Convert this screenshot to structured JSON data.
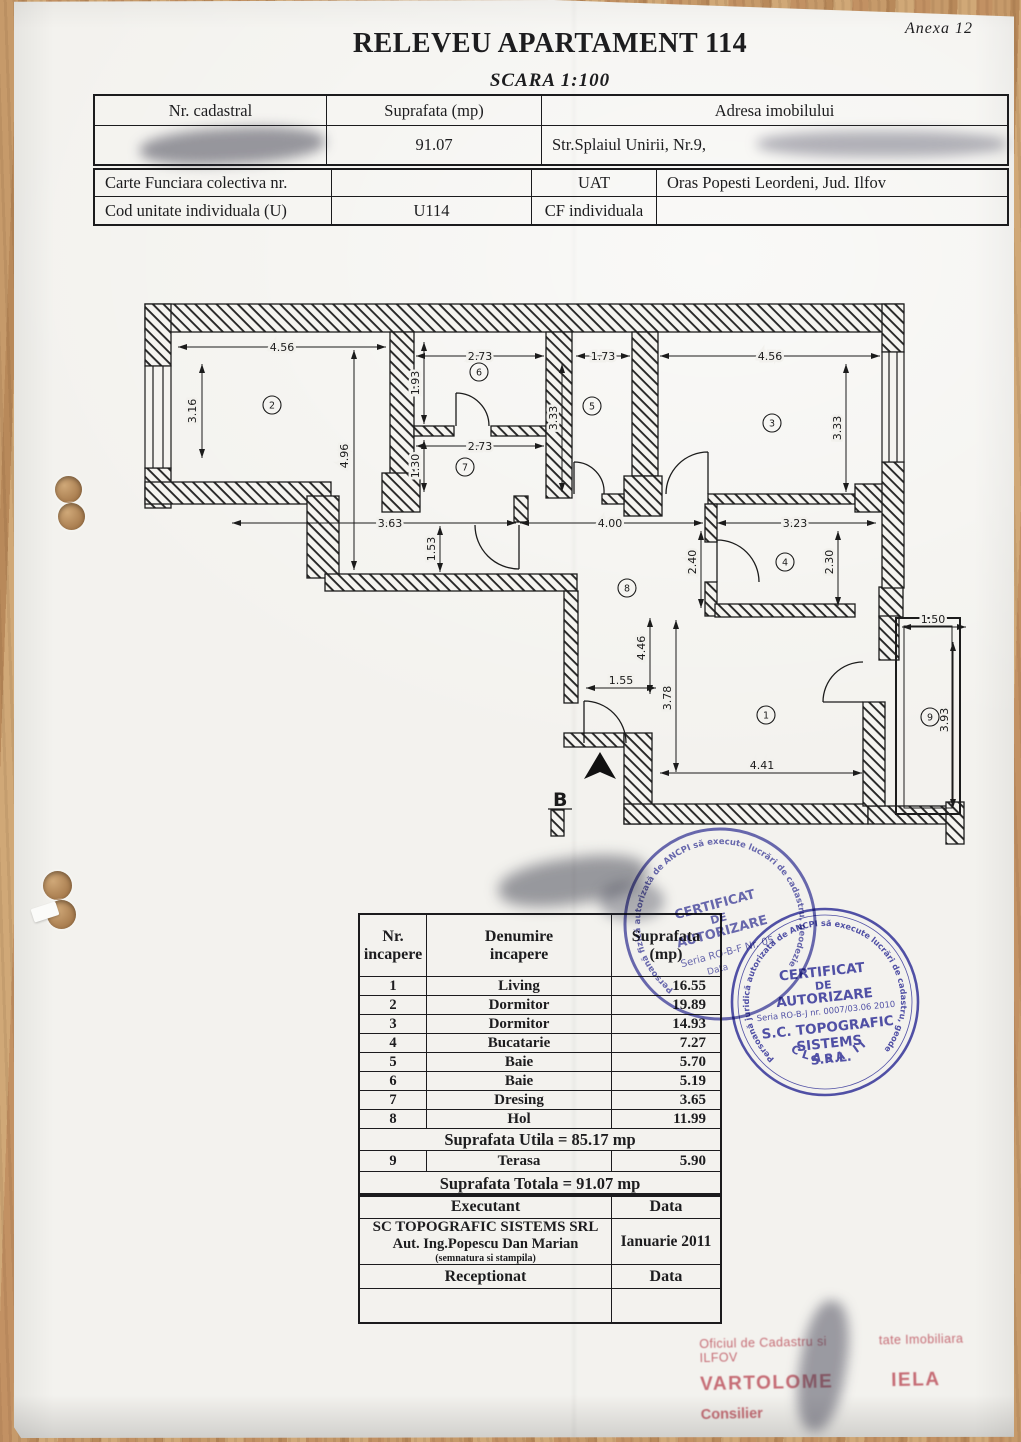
{
  "header": {
    "anexa": "Anexa 12",
    "title": "RELEVEU APARTAMENT 114",
    "scale": "SCARA 1:100"
  },
  "info_table": {
    "col1": "Nr. cadastral",
    "col2": "Suprafata (mp)",
    "col3": "Adresa imobilului",
    "area_value": "91.07",
    "address_value": "Str.Splaiul Unirii, Nr.9,"
  },
  "legal_table": {
    "row1_label": "Carte Funciara colectiva nr.",
    "uat_label": "UAT",
    "uat_value": "Oras Popesti Leordeni, Jud. Ilfov",
    "row2_label": "Cod unitate individuala (U)",
    "unit_value": "U114",
    "cf_label": "CF individuala"
  },
  "plan": {
    "north_label": "B",
    "room_numbers": {
      "r1": "1",
      "r2": "2",
      "r3": "3",
      "r4": "4",
      "r5": "5",
      "r6": "6",
      "r7": "7",
      "r8": "8",
      "r9": "9"
    },
    "dims": {
      "room2_w": "4.56",
      "room2_h": "3.16",
      "left_h": "4.96",
      "room6_w": "2.73",
      "room6_h": "1.93",
      "room7_w": "2.73",
      "room7_h": "1.30",
      "room5_w": "1.73",
      "room5_h": "3.33",
      "room3_w": "4.56",
      "room3_h": "3.33",
      "corridor_w": "3.63",
      "step_h": "1.53",
      "hall_w": "4.00",
      "kitchen_w": "3.23",
      "kitchen_hl": "2.40",
      "kitchen_h": "2.30",
      "hall_h": "4.46",
      "entry_w": "1.55",
      "living_h": "3.78",
      "living_w": "4.41",
      "terrace_w": "1.50",
      "terrace_h": "3.93"
    }
  },
  "rooms_table": {
    "header": {
      "nr1": "Nr.",
      "nr2": "incapere",
      "name1": "Denumire",
      "name2": "incapere",
      "area1": "Suprafata",
      "area2": "(mp)"
    },
    "rows": [
      {
        "nr": "1",
        "name": "Living",
        "area": "16.55"
      },
      {
        "nr": "2",
        "name": "Dormitor",
        "area": "19.89"
      },
      {
        "nr": "3",
        "name": "Dormitor",
        "area": "14.93"
      },
      {
        "nr": "4",
        "name": "Bucatarie",
        "area": "7.27"
      },
      {
        "nr": "5",
        "name": "Baie",
        "area": "5.70"
      },
      {
        "nr": "6",
        "name": "Baie",
        "area": "5.19"
      },
      {
        "nr": "7",
        "name": "Dresing",
        "area": "3.65"
      },
      {
        "nr": "8",
        "name": "Hol",
        "area": "11.99"
      }
    ],
    "subtotal": "Suprafata Utila = 85.17 mp",
    "terrace": {
      "nr": "9",
      "name": "Terasa",
      "area": "5.90"
    },
    "total": "Suprafata Totala = 91.07 mp"
  },
  "exec_table": {
    "executant": "Executant",
    "data": "Data",
    "company": "SC TOPOGRAFIC SISTEMS SRL",
    "engineer": "Aut. Ing.Popescu Dan Marian",
    "note": "(semnatura si stampila)",
    "date_value": "Ianuarie 2011",
    "receptionat": "Receptionat",
    "data2": "Data"
  },
  "stamps": {
    "blue_small": {
      "ring": "Persoană fizică autorizată de ANCPI să execute lucrări de cadastru, geodezie și cartografie",
      "l1": "CERTIFICAT",
      "l2": "DE",
      "l3": "AUTORIZARE",
      "serial": "Seria RO-B-F  Nr. 05",
      "extra": "Data"
    },
    "blue_large": {
      "ring": "Persoană juridică autorizată de ANCPI să execute lucrări de cadastru, geodezie, cartografie",
      "l1": "CERTIFICAT",
      "l2": "DE",
      "l3": "AUTORIZARE",
      "serial": "Seria RO-B-J nr. 0007/03.06 2010",
      "company1": "S.C. TOPOGRAFIC",
      "company2": "SISTEMS",
      "company3": "S.R.L.",
      "class_label": "CLASA II"
    },
    "office": {
      "l1a": "Oficiul de Cadastru si",
      "l1b": "tate Imobiliara ILFOV",
      "l2a": "VARTOLOME",
      "l2b": "IELA",
      "l3": "Consilier"
    }
  }
}
